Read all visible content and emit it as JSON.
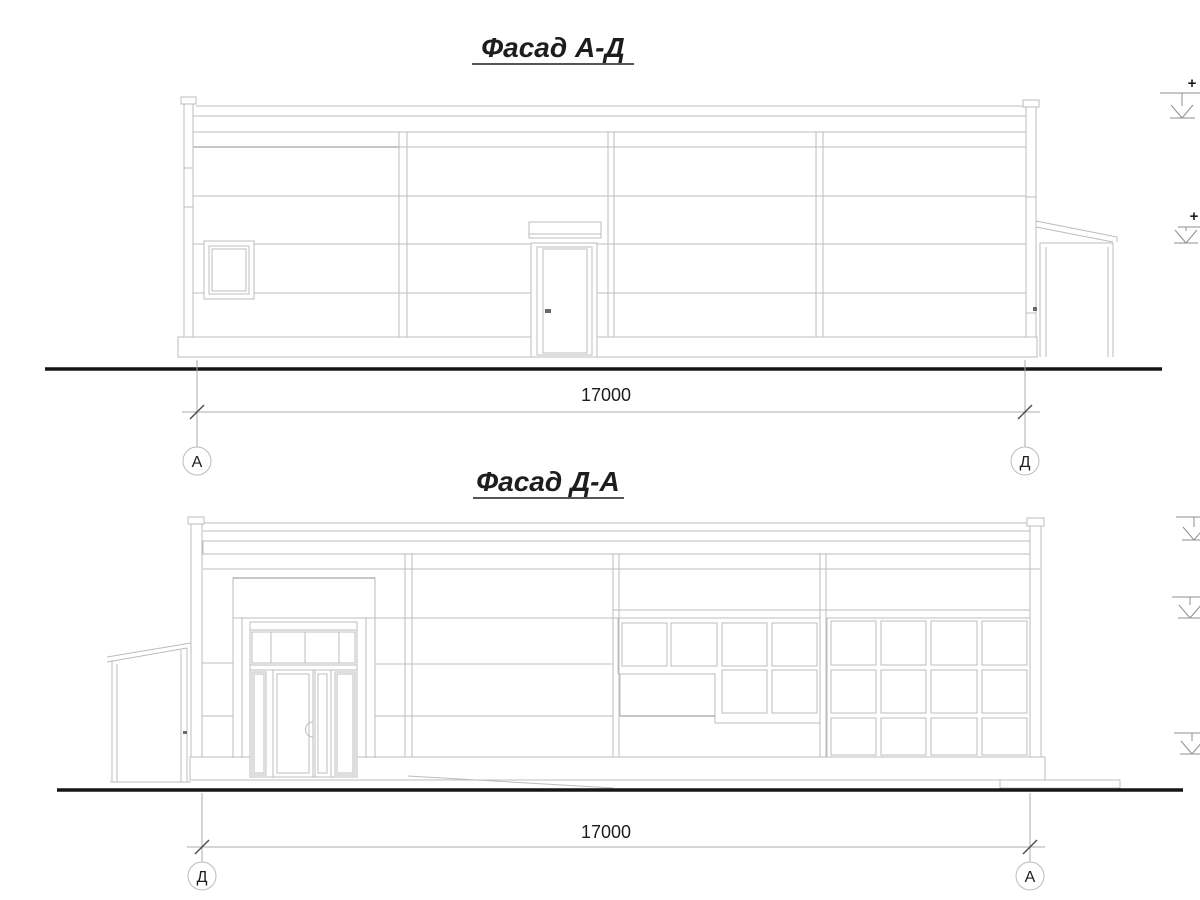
{
  "sheet": {
    "background": "#ffffff",
    "line_color": "#bcbcbc",
    "accent_line_color": "#8f8f8f",
    "ground_line_color": "#161616",
    "text_color": "#1d1d1d"
  },
  "facades": [
    {
      "title": "Фасад А-Д",
      "dimension": {
        "value": "17000",
        "left_axis": "А",
        "right_axis": "Д"
      },
      "elevation_marks": [
        {
          "label": "+"
        },
        {
          "label": "+"
        }
      ]
    },
    {
      "title": "Фасад Д-А",
      "dimension": {
        "value": "17000",
        "left_axis": "Д",
        "right_axis": "А"
      },
      "elevation_marks": [
        {
          "label": ""
        },
        {
          "label": ""
        },
        {
          "label": ""
        }
      ]
    }
  ]
}
